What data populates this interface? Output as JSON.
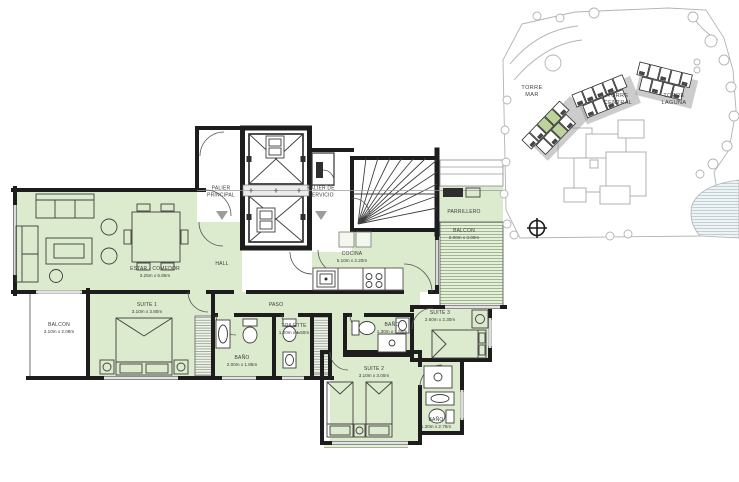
{
  "colors": {
    "room_fill": "#dceacd",
    "balcony_fill": "#e7efdc",
    "balcony_line": "#9db88c",
    "wall": "#1d1d1d",
    "tower_highlight": "#bcd49c",
    "site_line": "#b3b3b3",
    "label_text": "#3b3b3b"
  },
  "floor_plan": {
    "rooms": {
      "estar_comedor": {
        "name": "ESTAR - COMEDOR",
        "dims": "3.25m x 6.85m"
      },
      "suite_1": {
        "name": "SUITE 1",
        "dims": "3.10m x 3.80m"
      },
      "suite_2": {
        "name": "SUITE 2",
        "dims": "3.10m x 3.00m"
      },
      "suite_3": {
        "name": "SUITE 3",
        "dims": "2.60m x 2.30m"
      },
      "cocina": {
        "name": "COCINA",
        "dims": "5.10m x 2.20m"
      },
      "bano_1": {
        "name": "BAÑO",
        "dims": "2.00m x 1.85m"
      },
      "bano_2": {
        "name": "BAÑO",
        "dims": "1.30m x 1.55m"
      },
      "bano_3": {
        "name": "BAÑO",
        "dims": "1.30m x 2.75m"
      },
      "toilette": {
        "name": "TOILETTE",
        "dims": "1.20m x 1.50m"
      },
      "balcon_izq": {
        "name": "BALCON",
        "dims": "3.10m x 2.08m"
      },
      "balcon_der": {
        "name": "BALCON",
        "dims": "2.00m x 3.00m"
      },
      "parrillero": {
        "name": "PARRILLERO"
      },
      "paso": {
        "name": "PASO"
      },
      "hall": {
        "name": "HALL"
      },
      "palier_principal": {
        "name": "PALIER PRINCIPAL"
      },
      "palier_servicio": {
        "name": "PALIER DE SERVICIO"
      }
    }
  },
  "site_plan": {
    "towers": [
      {
        "label": "TORRE MAR"
      },
      {
        "label": "TORRE CENTRAL"
      },
      {
        "label": "TORRE LAGUNA"
      }
    ]
  }
}
